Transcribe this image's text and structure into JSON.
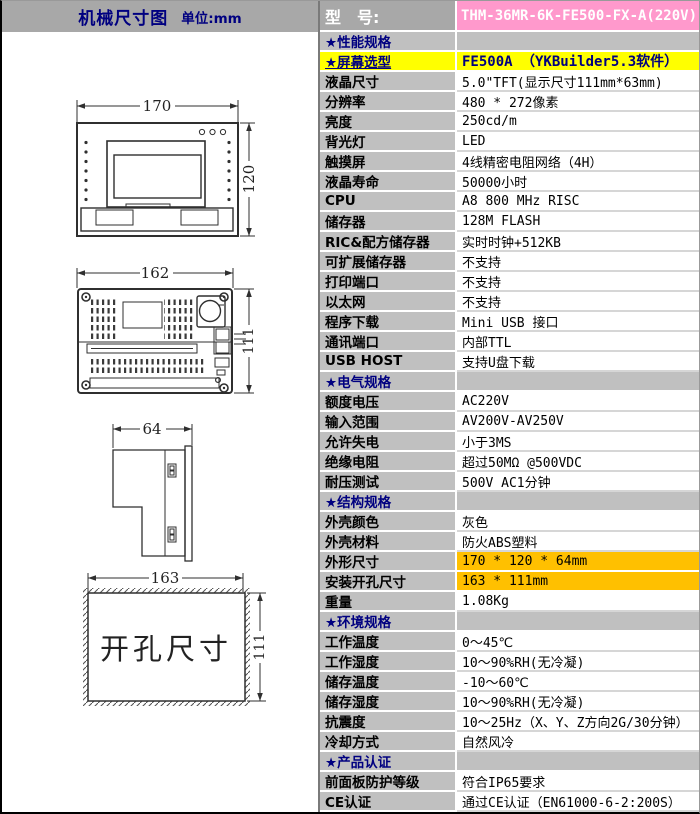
{
  "window": {
    "left_header": {
      "title": "机械尺寸图",
      "unit": "单位:mm"
    },
    "model": {
      "label": "型　号:",
      "value": "THM-36MR-6K-FE500-FX-A(220V)"
    },
    "colors": {
      "header_gray": "#a8a8a8",
      "cell_gray": "#c0c0c0",
      "model_pink": "#ff99cc",
      "highlight_yellow": "#ffff00",
      "highlight_orange": "#ffc000",
      "navy_text": "#000080"
    },
    "drawings": {
      "front": {
        "width": "170",
        "height": "120"
      },
      "rear": {
        "width": "162",
        "height": "111"
      },
      "side": {
        "width": "64"
      },
      "cutout": {
        "width": "163",
        "height": "111",
        "label": "开孔尺寸"
      }
    },
    "table": {
      "rows": [
        {
          "type": "section",
          "label": "★性能规格",
          "value": ""
        },
        {
          "type": "yellow",
          "label": "★屏幕选型",
          "value": "FE500A （YKBuilder5.3软件）"
        },
        {
          "type": "normal",
          "label": "液晶尺寸",
          "value": "5.0\"TFT(显示尺寸111mm*63mm)"
        },
        {
          "type": "normal",
          "label": "分辨率",
          "value": "480 * 272像素"
        },
        {
          "type": "normal",
          "label": "亮度",
          "value": "250cd/m"
        },
        {
          "type": "normal",
          "label": "背光灯",
          "value": "LED"
        },
        {
          "type": "normal",
          "label": "触摸屏",
          "value": "4线精密电阻网络（4H）"
        },
        {
          "type": "normal",
          "label": "液晶寿命",
          "value": "50000小时"
        },
        {
          "type": "normal",
          "label": "CPU",
          "value": "A8 800 MHz RISC"
        },
        {
          "type": "normal",
          "label": "储存器",
          "value": "128M FLASH"
        },
        {
          "type": "normal",
          "label": "RIC&配方储存器",
          "value": "实时时钟+512KB"
        },
        {
          "type": "normal",
          "label": "可扩展储存器",
          "value": "不支持"
        },
        {
          "type": "normal",
          "label": "打印端口",
          "value": "不支持"
        },
        {
          "type": "normal",
          "label": "以太网",
          "value": "不支持"
        },
        {
          "type": "normal",
          "label": "程序下载",
          "value": "Mini USB 接口"
        },
        {
          "type": "normal",
          "label": "通讯端口",
          "value": "内部TTL"
        },
        {
          "type": "normal",
          "label": "USB HOST",
          "value": "支持U盘下载"
        },
        {
          "type": "section",
          "label": "★电气规格",
          "value": ""
        },
        {
          "type": "normal",
          "label": "额度电压",
          "value": "AC220V"
        },
        {
          "type": "normal",
          "label": "输入范围",
          "value": "AV200V-AV250V"
        },
        {
          "type": "normal",
          "label": "允许失电",
          "value": "小于3MS"
        },
        {
          "type": "normal",
          "label": "绝缘电阻",
          "value": "超过50MΩ @500VDC"
        },
        {
          "type": "normal",
          "label": "耐压测试",
          "value": "500V AC1分钟"
        },
        {
          "type": "section",
          "label": "★结构规格",
          "value": ""
        },
        {
          "type": "normal",
          "label": "外壳颜色",
          "value": "灰色"
        },
        {
          "type": "normal",
          "label": "外壳材料",
          "value": "防火ABS塑料"
        },
        {
          "type": "orange",
          "label": "外形尺寸",
          "value": "170 * 120 * 64mm"
        },
        {
          "type": "orange",
          "label": "安装开孔尺寸",
          "value": "163 * 111mm"
        },
        {
          "type": "normal",
          "label": "重量",
          "value": "1.08Kg"
        },
        {
          "type": "section",
          "label": "★环境规格",
          "value": ""
        },
        {
          "type": "normal",
          "label": "工作温度",
          "value": "0～45℃"
        },
        {
          "type": "normal",
          "label": "工作湿度",
          "value": "10～90%RH(无冷凝)"
        },
        {
          "type": "normal",
          "label": "储存温度",
          "value": "-10～60℃"
        },
        {
          "type": "normal",
          "label": "储存湿度",
          "value": "10～90%RH(无冷凝)"
        },
        {
          "type": "normal",
          "label": "抗震度",
          "value": "10～25Hz（X、Y、Z方向2G/30分钟）"
        },
        {
          "type": "normal",
          "label": "冷却方式",
          "value": "自然风冷"
        },
        {
          "type": "section",
          "label": "★产品认证",
          "value": ""
        },
        {
          "type": "normal",
          "label": "前面板防护等级",
          "value": "符合IP65要求"
        },
        {
          "type": "normal",
          "label": "CE认证",
          "value": "通过CE认证（EN61000-6-2:200S）"
        }
      ]
    }
  }
}
